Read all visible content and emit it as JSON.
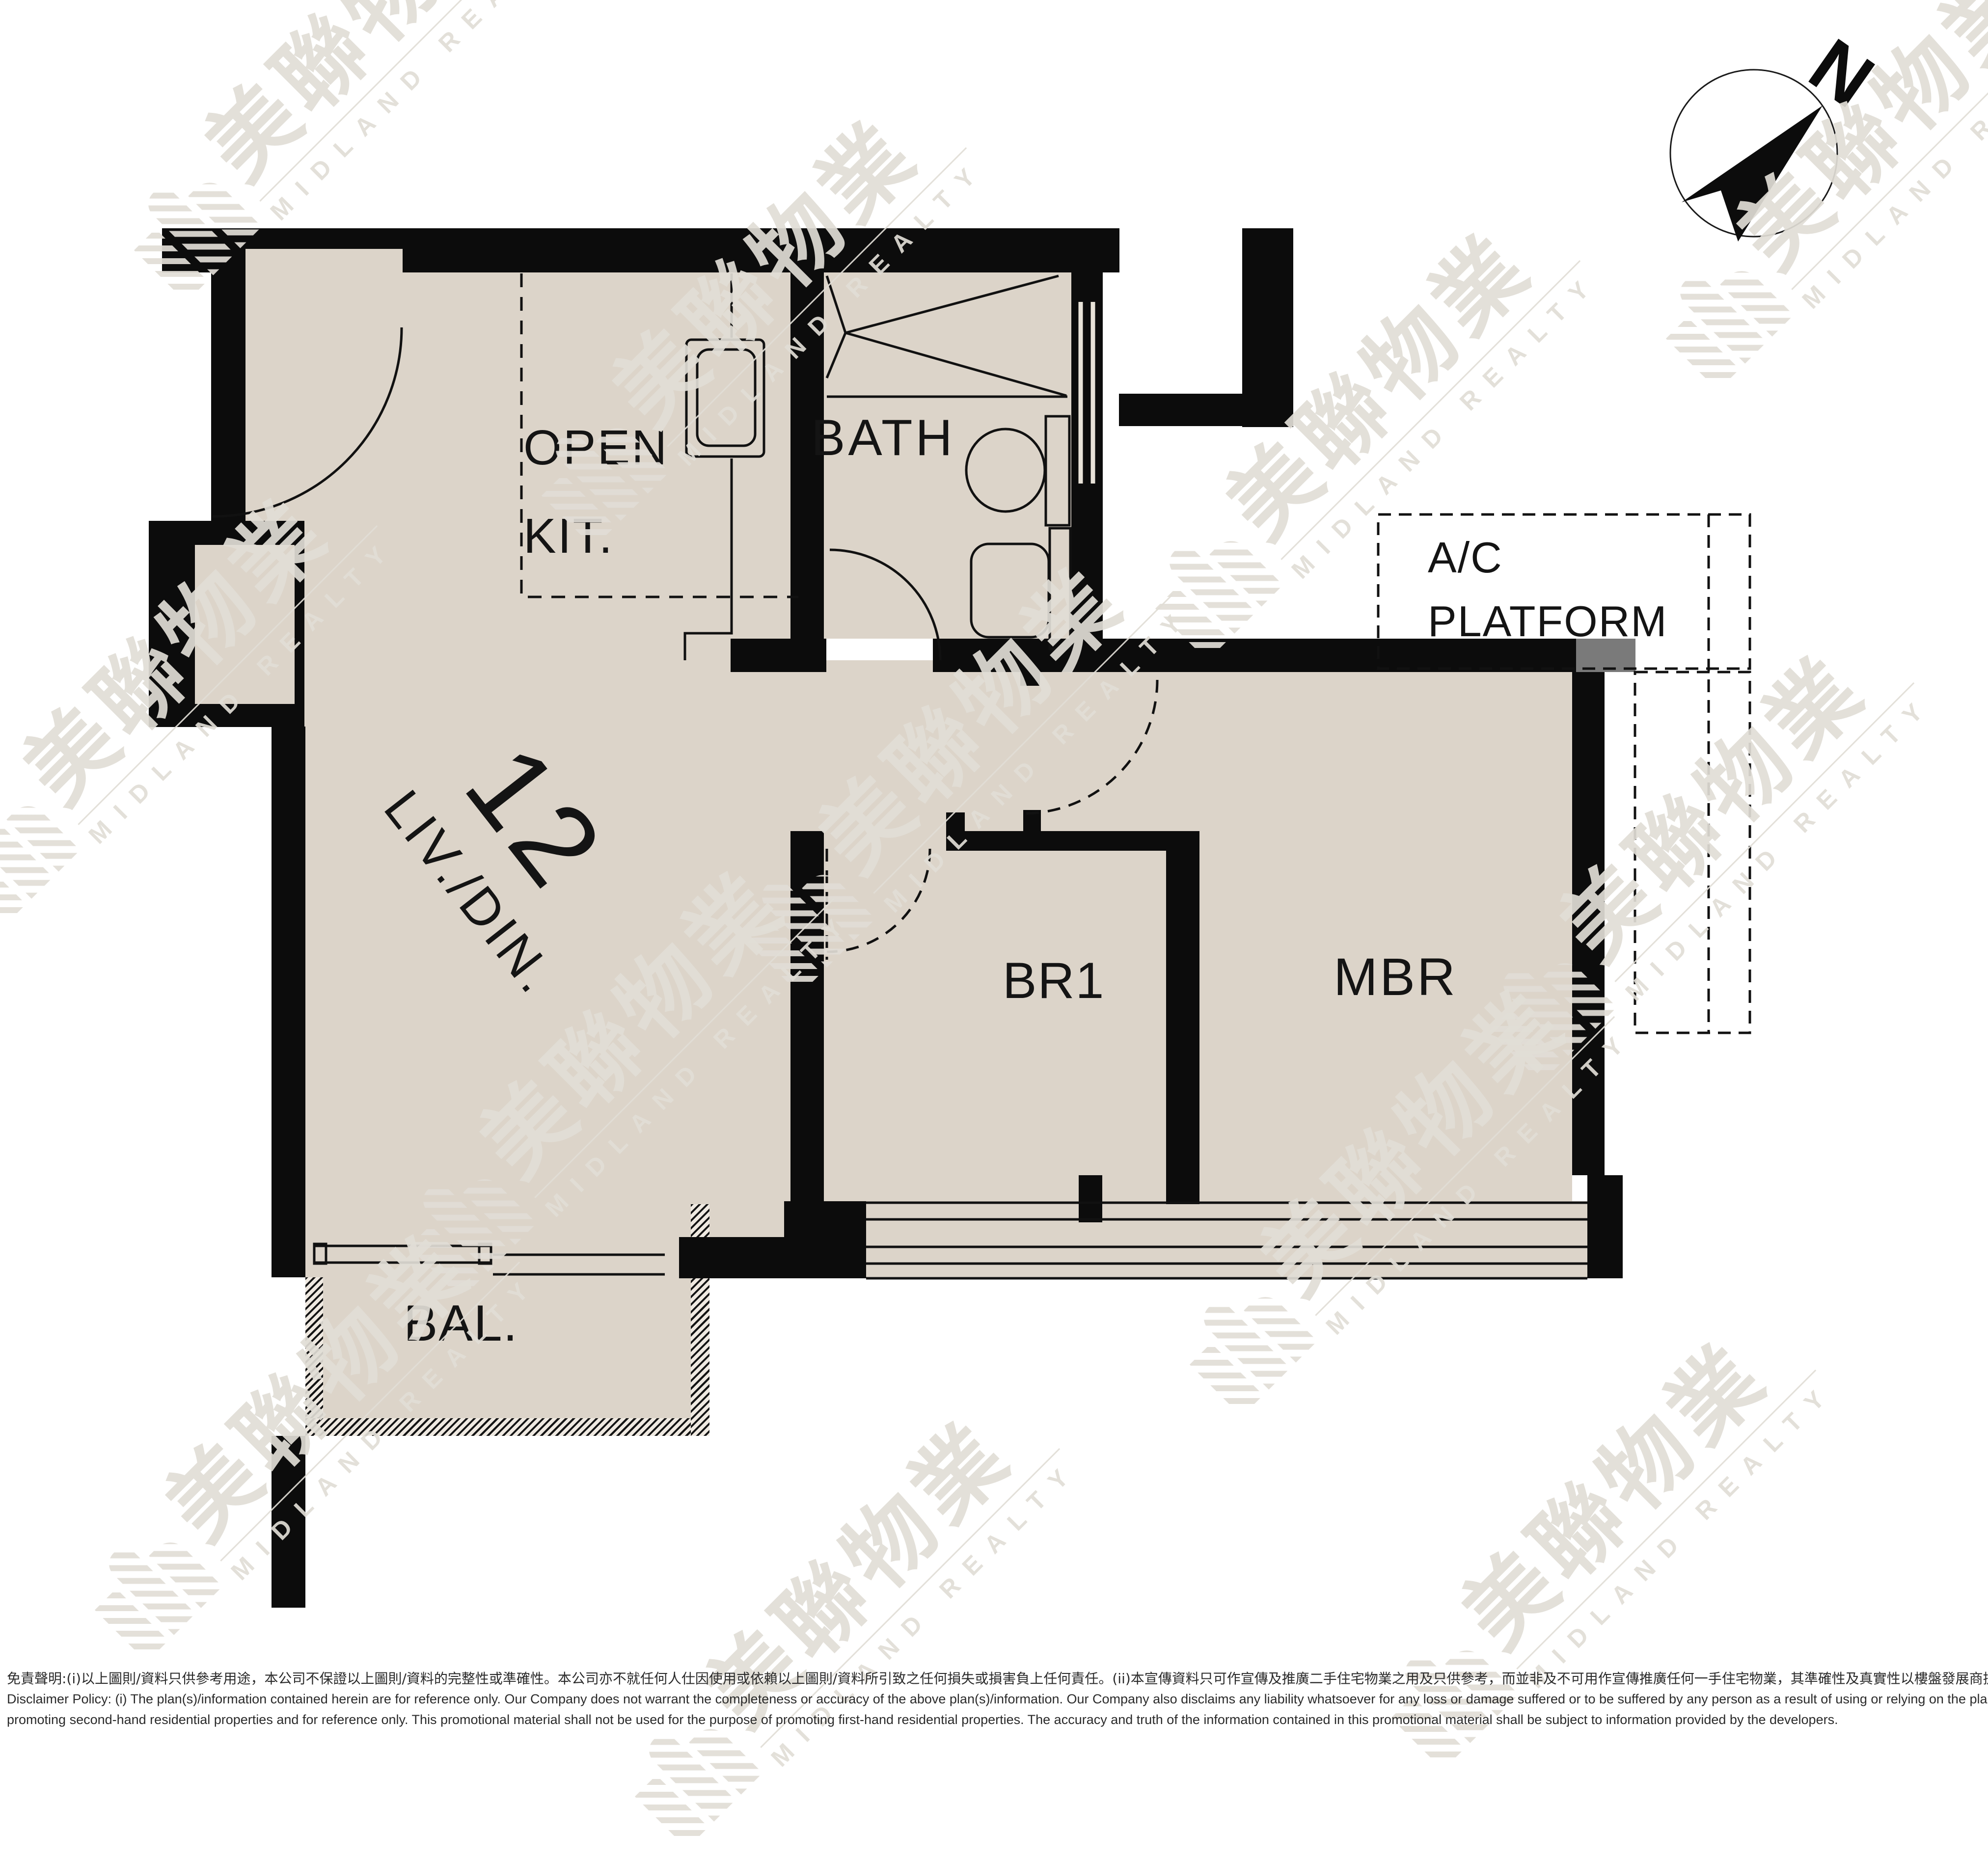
{
  "floorplan": {
    "unit_number": "12",
    "rooms": {
      "living_dining": "LIV./DIN.",
      "open_kitchen_line1": "OPEN",
      "open_kitchen_line2": "KIT.",
      "bath": "BATH",
      "bedroom1": "BR1",
      "master_bedroom": "MBR",
      "balcony": "BAL.",
      "ac_platform_line1": "A/C",
      "ac_platform_line2": "PLATFORM"
    },
    "compass": {
      "north_label": "N"
    },
    "colors": {
      "floor": "#dcd4c9",
      "wall": "#0c0c0c",
      "gray_block": "#7a7a7a",
      "watermark": "rgba(225,221,214,0.92)"
    }
  },
  "watermark": {
    "chinese": "美聯物業",
    "english": "MIDLAND REALTY"
  },
  "disclaimer": {
    "line1_zh": "免責聲明:(i)以上圖則/資料只供參考用途，本公司不保證以上圖則/資料的完整性或準確性。本公司亦不就任何人仕因使用或依賴以上圖則/資料所引致之任何損失或損害負上任何責任。(ii)本宣傳資料只可作宣傳及推廣二手住宅物業之用及只供參考，而並非及不可用作宣傳推廣任何一手住宅物業，其準確性及真實性以樓盤發展商提供的資料為準。",
    "line2_en": "Disclaimer Policy: (i) The plan(s)/information contained herein are for reference only. Our Company does not warrant the completeness or accuracy of the above plan(s)/information. Our Company also disclaims any liability whatsoever for any loss or damage suffered or to be suffered by any person as a result of using or relying on the plan(s)/information. (ii) This promotional material is for the purpose of",
    "line3_en": "promoting second-hand residential properties and for reference only. This promotional material shall not be used for the purpose of promoting first-hand residential properties. The accuracy and truth of the information contained in this promotional material shall be subject to information provided by the developers."
  }
}
